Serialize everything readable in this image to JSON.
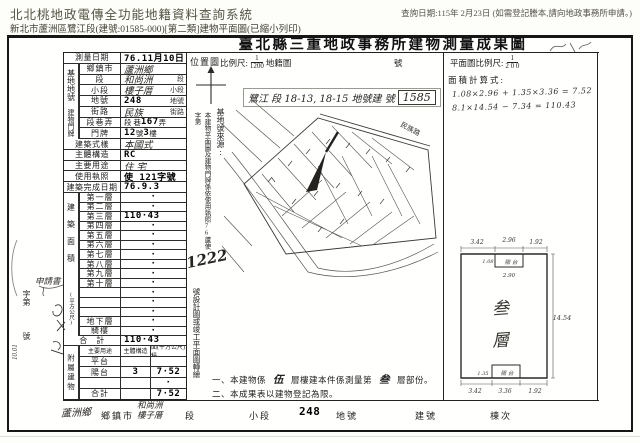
{
  "colors": {
    "paper": "#ffffff",
    "ink": "#1a1a1a",
    "header_text": "#55544a"
  },
  "header": {
    "system_title": "北北桃地政電傳全功能地籍資料查詢系統",
    "query_note": "查詢日期:115年 2月23日 (如需登記謄本,請向地政事務所申請。)",
    "subtitle": "新北市蘆洲區鷺江段(建號:01585-000)[第二類]建物平面圖(已縮小列印)"
  },
  "doc": {
    "title": "臺北縣三重地政事務所建物測量成果圖",
    "left": {
      "g_site": "基地地號",
      "g_door": "建物門牌",
      "g_area": "建築面積",
      "g_area_unit": "(平方公尺)",
      "g_annex": "附屬建物",
      "rows_top": [
        {
          "l": "測量日期",
          "v": "76.11月10日",
          "cls": "dot",
          "span": true
        },
        {
          "l": "鄉鎮市",
          "v": "蘆洲鄉",
          "cls": "hand"
        },
        {
          "l": "段",
          "v": "和尚洲",
          "cls": "hand",
          "suf": "段"
        },
        {
          "l": "小段",
          "v": "樓子厝",
          "cls": "hand",
          "suf": "小段"
        },
        {
          "l": "地號",
          "v": "248",
          "cls": "dot",
          "suf": "地號"
        },
        {
          "l": "街路",
          "v": "民族",
          "cls": "hand",
          "suf": "街路"
        },
        {
          "l": "段巷弄",
          "parts": [
            {
              "t": "段 巷",
              "c": "prt"
            },
            {
              "t": "167",
              "c": "dot"
            },
            {
              "t": "弄",
              "c": "prt"
            }
          ]
        },
        {
          "l": "門牌",
          "parts": [
            {
              "t": "12",
              "c": "dot"
            },
            {
              "t": "號 ",
              "c": "prt"
            },
            {
              "t": "3",
              "c": "dot"
            },
            {
              "t": " 樓",
              "c": "prt"
            }
          ]
        },
        {
          "l": "建築式樣",
          "v": "本國式",
          "cls": "hand",
          "span": true
        },
        {
          "l": "主體構造",
          "v": "RC",
          "cls": "dot",
          "span": true
        },
        {
          "l": "主要用途",
          "v": "住 宅",
          "cls": "hand",
          "span": true
        },
        {
          "l": "使用執照",
          "v": "使 121字號",
          "cls": "dot",
          "span": true
        },
        {
          "l": "建築完成日期",
          "v": "76.9.3",
          "cls": "dot",
          "span": true
        }
      ],
      "rows_area": [
        {
          "l": "第一層",
          "v": "·",
          "cls": "dotc"
        },
        {
          "l": "第二層",
          "v": "·",
          "cls": "dotc"
        },
        {
          "l": "第三層",
          "v": "110·43",
          "cls": "dot"
        },
        {
          "l": "第四層",
          "v": "·",
          "cls": "dotc"
        },
        {
          "l": "第五層",
          "v": "·",
          "cls": "dotc"
        },
        {
          "l": "第六層",
          "v": "·",
          "cls": "dotc"
        },
        {
          "l": "第七層",
          "v": "·",
          "cls": "dotc"
        },
        {
          "l": "第八層",
          "v": "·",
          "cls": "dotc"
        },
        {
          "l": "第九層",
          "v": "·",
          "cls": "dotc"
        },
        {
          "l": "第十層",
          "v": "·",
          "cls": "dotc"
        },
        {
          "l": "",
          "v": "·",
          "cls": "dotc"
        },
        {
          "l": "",
          "v": "·",
          "cls": "dotc"
        },
        {
          "l": "",
          "v": "·",
          "cls": "dotc"
        },
        {
          "l": "地下層",
          "v": "·",
          "cls": "dotc"
        },
        {
          "l": "騎樓",
          "v": "·",
          "cls": "dotc"
        },
        {
          "l": "合　計",
          "v": "110·43",
          "cls": "dot",
          "span": true
        }
      ],
      "annex_headers": [
        "主要用途",
        "主體構造",
        "面(平方公尺)積"
      ],
      "rows_annex": [
        {
          "u": "平台",
          "s": "",
          "a": ""
        },
        {
          "u": "陽台",
          "s": "3",
          "a": "7·52"
        },
        {
          "u": "",
          "s": "",
          "a": "·"
        },
        {
          "u": "合計",
          "s": "",
          "a": "7·52"
        }
      ]
    },
    "margin": {
      "apply_stamp": "申請書",
      "zidi": "字第",
      "hao": "號",
      "rotated_note": "10.01"
    },
    "location": {
      "label": "位置圖",
      "scale_label": "比例尺:",
      "scale_num": "1",
      "scale_den": "1200",
      "scale_suffix": "地籍圖",
      "sheet_no_label": "號",
      "hand_line": "鷺江 段 18-13, 18-15 地號建 號",
      "hand_boxed": "1585",
      "road_label": "民族路",
      "source_label": "基地號來源:",
      "derivation": "本建物平面圖及建物門牌係依使用執照76蘆使字第",
      "derivation_no": "1222",
      "derivation2": "號設計圖或竣工平面圖轉繪",
      "note1_a": "一、本建物係",
      "note1_b": "伍",
      "note1_c": "層樓建本件係測量第",
      "note1_d": "叁",
      "note1_e": "層部份。",
      "note2": "二、本成果表以建物登記為限。"
    },
    "plan": {
      "scale_label": "平面圖比例尺:",
      "scale_num": "1",
      "scale_den": "2 0 0",
      "calc_label": "面積計算式:",
      "calc1": "1.08×2.96 + 1.35×3.36 = 7.52",
      "calc2": "8.1×14.54 − 7.34 = 110.43",
      "floor_char1": "叁",
      "floor_char2": "層",
      "balcony_top": "陽 台",
      "balcony_bottom": "陽 台",
      "dims": {
        "top_left": "3.42",
        "top_mid": "2.96",
        "top_right": "1.92",
        "notch_h": "1.08",
        "notch_w": "2.90",
        "right": "14.54",
        "bot_notch_h": "1.35",
        "bot_left": "3.42",
        "bot_mid": "3.36",
        "bot_right": "1.92"
      }
    },
    "footer": {
      "township_value": "蘆洲鄉",
      "township_label": "鄉鎮市",
      "section_value_1": "和尚洲",
      "section_value_2": "樓子厝",
      "section_label": "段",
      "subsection_label": "小段",
      "parcel_value": "248",
      "parcel_label": "地號",
      "building_label": "建號",
      "unit_label": "棟次"
    }
  }
}
